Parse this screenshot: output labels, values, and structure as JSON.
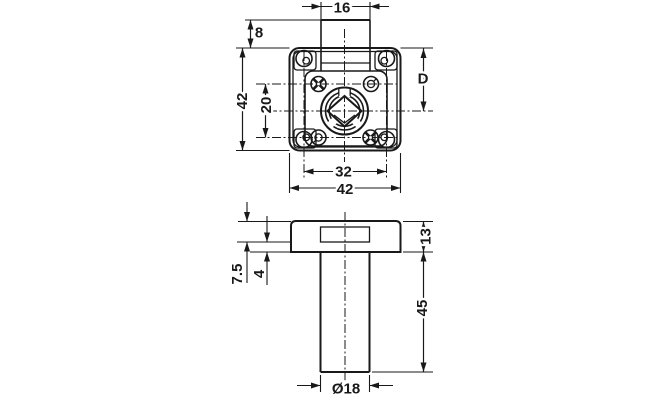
{
  "colors": {
    "line": "#191919",
    "background": "#ffffff"
  },
  "top_view": {
    "dim_tab_width": "16",
    "dim_tab_offset": "8",
    "dim_plate_height": "42",
    "dim_screw_spacing_vertical": "20",
    "dim_backset": "D",
    "dim_screw_spacing_horizontal": "32",
    "dim_plate_width": "42"
  },
  "side_view": {
    "dim_flange_thickness": "13",
    "dim_case_recess": "7.5",
    "dim_lip": "4",
    "dim_cylinder_length": "45",
    "dim_cylinder_diameter": "Ø18"
  }
}
